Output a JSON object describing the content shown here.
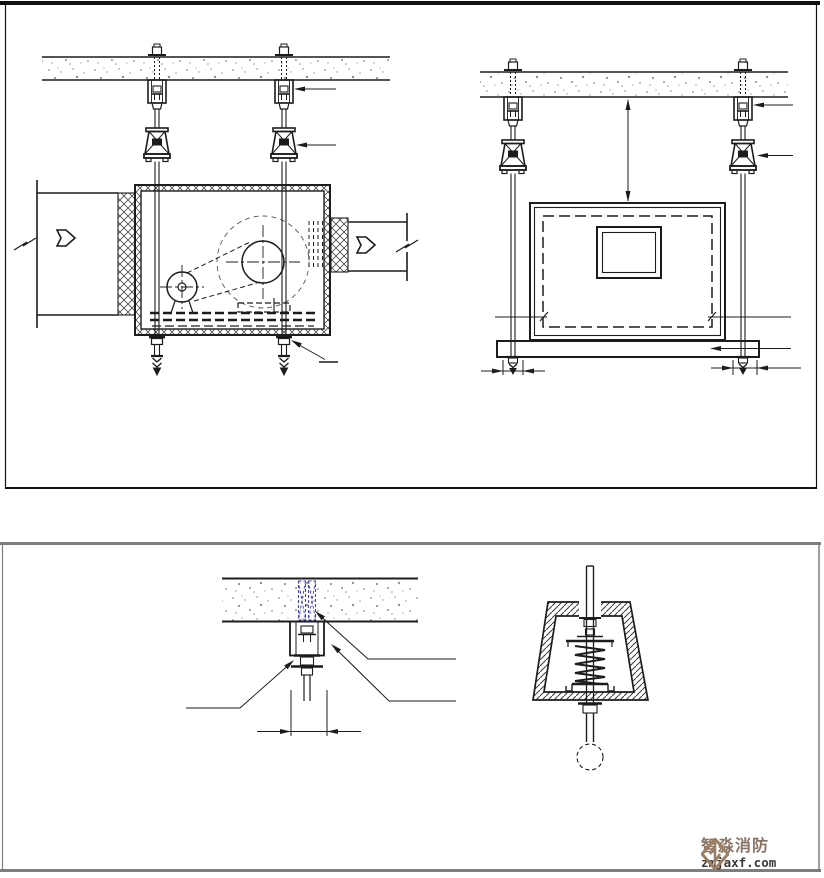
{
  "logo": {
    "icon": "diamond-fold-icon",
    "title": "智淼消防",
    "domain": "zmjaxf.com"
  },
  "colors": {
    "line": "#1c1c1c",
    "line_light": "#555555",
    "concrete": "#8f8f8f",
    "anchor_blue": "#4343b2",
    "panel_border": "#111111",
    "panel2_border": "#7e7e7e",
    "logo_tan": "#9c8066",
    "logo_text": "#8a7365",
    "logo_domain": "#3d3833",
    "background": "#ffffff"
  },
  "drawings": {
    "side_view": "suspended-fan-unit-side-elevation",
    "front_view": "suspended-fan-unit-front-elevation",
    "anchor_detail": "embedded-anchor-bolt-detail",
    "isolator_detail": "spring-vibration-isolator-section"
  }
}
